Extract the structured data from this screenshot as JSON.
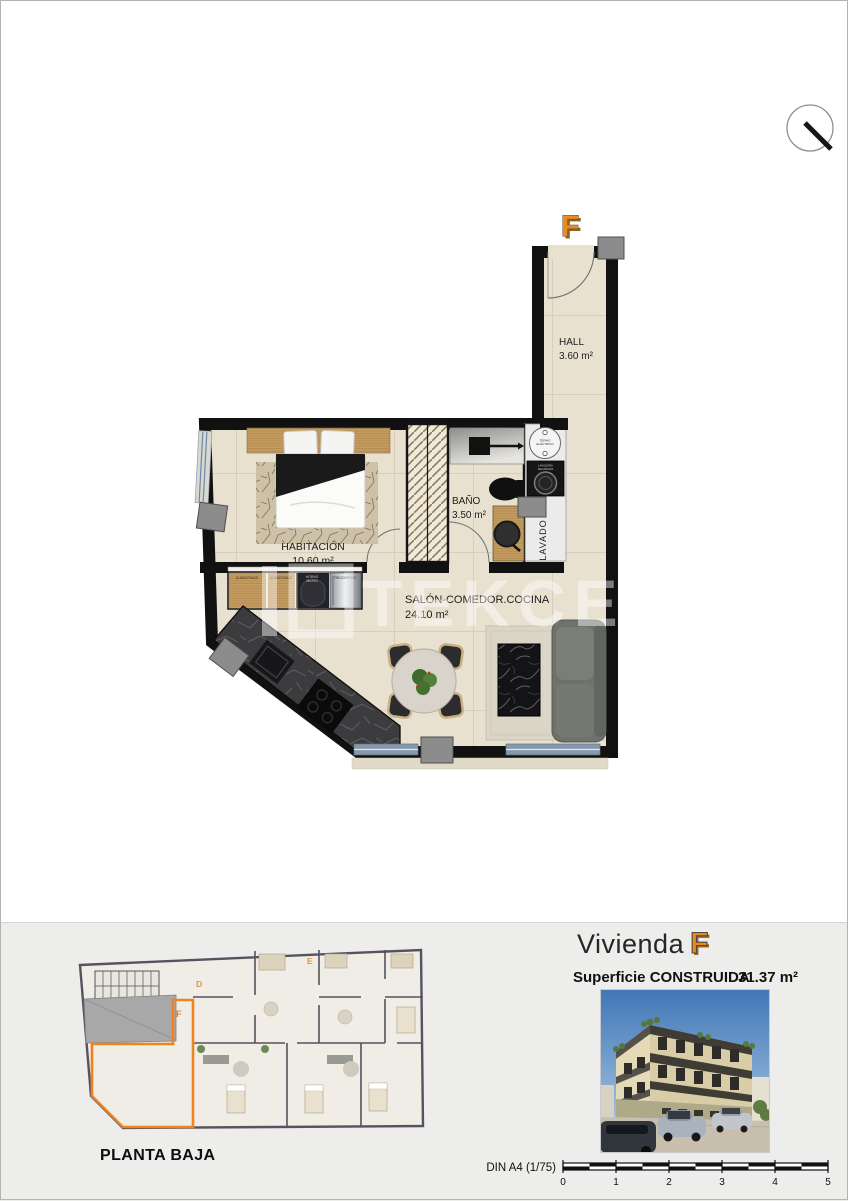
{
  "plan": {
    "unit_label": "F",
    "rooms": {
      "hall": {
        "name": "HALL",
        "area": "3.60 m²"
      },
      "bano": {
        "name": "BAÑO",
        "area": "3.50 m²"
      },
      "habitacion": {
        "name": "HABITACIÓN",
        "area": "10.60 m²"
      },
      "salon": {
        "name": "SALÓN-COMEDOR.COCINA",
        "area": "24.10 m²"
      },
      "lavado": {
        "name": "LAVADO"
      }
    },
    "fixtures": {
      "termo_line1": "TERMO",
      "termo_line2": "ELÉCTRICO",
      "lavadora_line1": "LAVADORA",
      "lavadora_line2": "SECADORA",
      "almacenaje_1": "ALMACENAJE",
      "almacenaje_2": "ALMACENAJE",
      "horno_line1": "HORNO",
      "horno_line2": "MICRO",
      "frigorifico": "FRIGORÍFICO"
    },
    "watermark": "TEKCE"
  },
  "footer": {
    "site_plan_title": "PLANTA BAJA",
    "site_plan_unit_d": "D",
    "site_plan_unit_e": "E",
    "site_plan_unit_f": "F",
    "title_prefix": "Vivienda",
    "title_unit": "F",
    "surface_label": "Superficie CONSTRUIDA",
    "surface_value": "31.37 m²",
    "scale_label": "DIN A4 (1/75)",
    "scale_ticks": [
      "0",
      "1",
      "2",
      "3",
      "4",
      "5"
    ]
  },
  "colors": {
    "accent_orange": "#ee871c",
    "wall_black": "#111111",
    "siteplan_wall": "#57525e",
    "panel_bg": "#ededec"
  }
}
